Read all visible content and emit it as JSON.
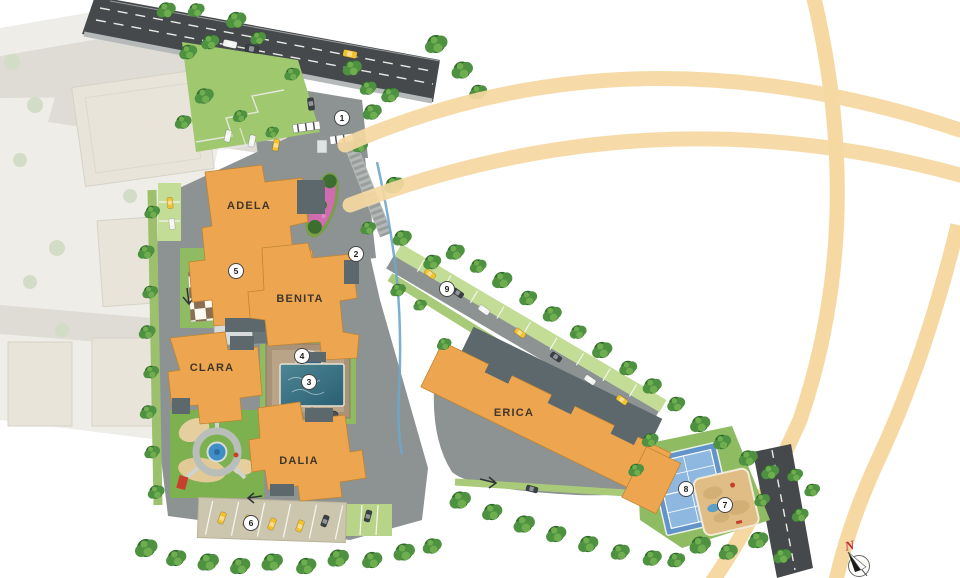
{
  "plan": {
    "buildings": [
      {
        "label": "ADELA"
      },
      {
        "label": "BENITA"
      },
      {
        "label": "CLARA"
      },
      {
        "label": "DALIA"
      },
      {
        "label": "ERICA"
      }
    ],
    "markers": [
      {
        "number": "1"
      },
      {
        "number": "2"
      },
      {
        "number": "3"
      },
      {
        "number": "4"
      },
      {
        "number": "5"
      },
      {
        "number": "6"
      },
      {
        "number": "7"
      },
      {
        "number": "8"
      },
      {
        "number": "9"
      }
    ],
    "compass": {
      "north_label": "N"
    }
  },
  "colors": {
    "buildingFill": "#eda64f",
    "buildingEdge": "#c08433",
    "roofDark": "#5d686c",
    "roadMain": "#45494c",
    "roadInner": "#8d9293",
    "green": "#8fbc62",
    "greenLight": "#b7d489",
    "lawn": "#9fc86f",
    "bays": "#c3dd96",
    "tree": "#2f6b2a",
    "treeMid": "#4e9140",
    "treeLight": "#6fae4f",
    "pool": "#417f8e",
    "poolKids": "#2d5f86",
    "courtBlue": "#8fb8e0",
    "courtBlueDark": "#6294cb",
    "sand": "#dfbd85",
    "deck": "#a89378",
    "checkerBrown": "#8a6f52",
    "checkerWhite": "#fbf9f1",
    "arcGold": "#f6d9a2",
    "fadedBuilding": "#e9e4da",
    "fadedRoad": "#dedcd5",
    "fadedBase": "#efede8",
    "stream": "#6fa6cc",
    "carYellow": "#f2c12e",
    "carWhite": "#f2f3f1",
    "carDark": "#3a4045",
    "markerBg": "#ffffff",
    "markerBorder": "#444444",
    "markerText": "#1c1c1a",
    "labelText": "#3f362b",
    "compassRed": "#c0272d",
    "paving": "#cdc6ae",
    "wall": "#b4b9b7"
  }
}
